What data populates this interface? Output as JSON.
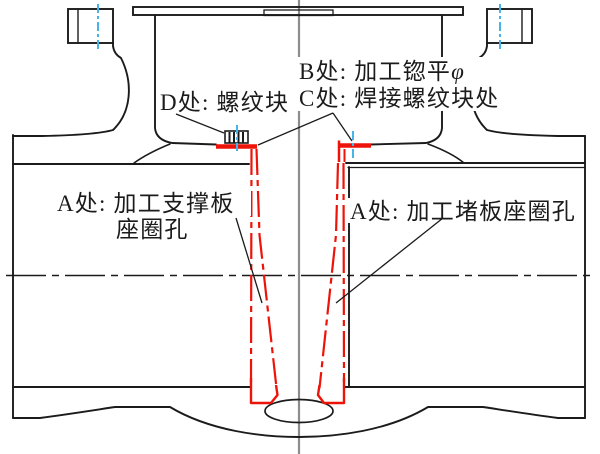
{
  "drawing": {
    "title": "valve-body-section-machining-diagram",
    "labels": {
      "d": "D处: 螺纹块",
      "b": "B处: 加工锪平",
      "b_phi": "φ",
      "c": "C处: 焊接螺纹块处",
      "a_left_line1": "A处: 加工支撑板",
      "a_left_line2": "座圈孔",
      "a_right": "A处: 加工堵板座圈孔"
    },
    "colors": {
      "highlight_red": "#ee1309",
      "centerline_cyan": "#45b4e8",
      "axis_gray": "#8c8c8c",
      "line_black": "#1b1b1b"
    }
  }
}
